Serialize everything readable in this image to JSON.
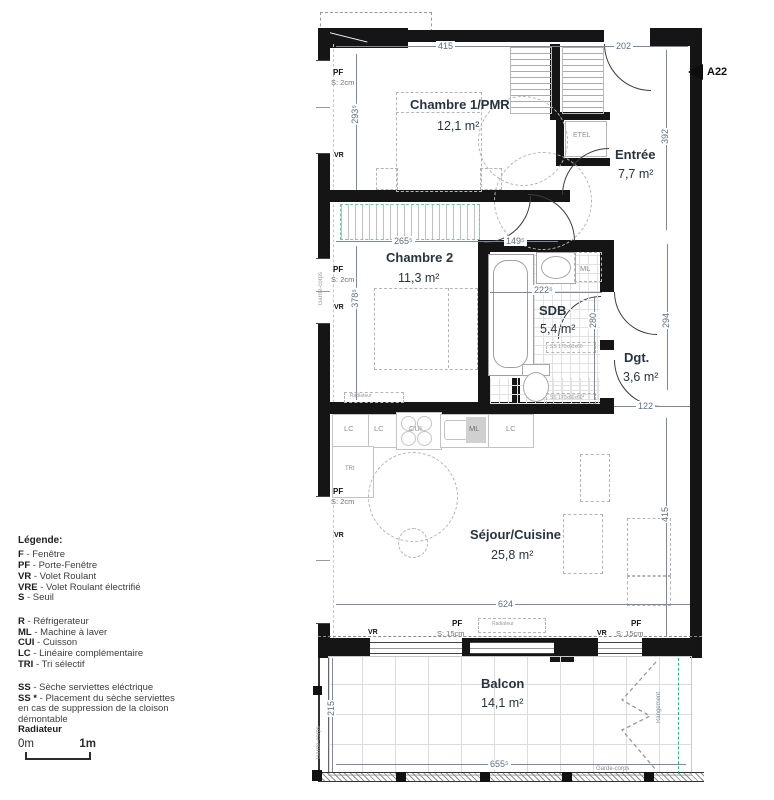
{
  "marker": {
    "label": "A22"
  },
  "rooms": {
    "chambre1": {
      "name": "Chambre 1/PMR",
      "area": "12,1 m²"
    },
    "entree": {
      "name": "Entrée",
      "area": "7,7 m²"
    },
    "chambre2": {
      "name": "Chambre 2",
      "area": "11,3 m²"
    },
    "sdb": {
      "name": "SDB",
      "area": "5,4 m²"
    },
    "dgt": {
      "name": "Dgt.",
      "area": "3,6 m²"
    },
    "sejour": {
      "name": "Séjour/Cuisine",
      "area": "25,8 m²"
    },
    "balcon": {
      "name": "Balcon",
      "area": "14,1 m²"
    }
  },
  "dims": {
    "d415_top": "415",
    "d202": "202",
    "d2935": "293⁵",
    "d392": "392",
    "d2655": "265⁵",
    "d1495": "149⁵",
    "d3785": "378⁵",
    "d2225": "222⁵",
    "d280": "280",
    "d294": "294",
    "d122": "122",
    "d624": "624",
    "d415_right": "415",
    "d215": "215",
    "d6555": "655⁵"
  },
  "wall_labels": {
    "pf": "PF",
    "vr": "VR",
    "s2": "S: 2cm",
    "s15": "S: 15cm"
  },
  "fixtures": {
    "etel": "ETEL",
    "ml": "ML",
    "cui": "CUI",
    "lc": "LC",
    "tri": "TRI",
    "ss1": "SS 170x60x60",
    "ss2": "SS 170x60x60*",
    "radiateur": "Radiateur",
    "garde_corps": "Garde-corps",
    "rangement": "Rangement"
  },
  "legend": {
    "title": "Légende:",
    "groups": [
      {
        "items": [
          {
            "term": "F",
            "desc": "- Fenêtre"
          },
          {
            "term": "PF",
            "desc": "- Porte-Fenêtre"
          },
          {
            "term": "VR",
            "desc": "- Volet Roulant"
          },
          {
            "term": "VRE",
            "desc": "- Volet Roulant électrifié"
          },
          {
            "term": "S",
            "desc": "- Seuil"
          }
        ]
      },
      {
        "items": [
          {
            "term": "R",
            "desc": "- Réfrigerateur"
          },
          {
            "term": "ML",
            "desc": "- Machine à laver"
          },
          {
            "term": "CUI",
            "desc": "- Cuisson"
          },
          {
            "term": "LC",
            "desc": "- Linéaire complémentaire"
          },
          {
            "term": "TRI",
            "desc": "- Tri sélectif"
          }
        ]
      },
      {
        "items": [
          {
            "term": "SS",
            "desc": "- Sèche serviettes eléctrique"
          },
          {
            "term": "SS *",
            "desc": "- Placement du sèche serviettes en cas de suppression de la cloison démontable"
          },
          {
            "term": "Radiateur",
            "desc": ""
          }
        ]
      }
    ]
  },
  "scalebar": {
    "zero": "0m",
    "one": "1m"
  }
}
